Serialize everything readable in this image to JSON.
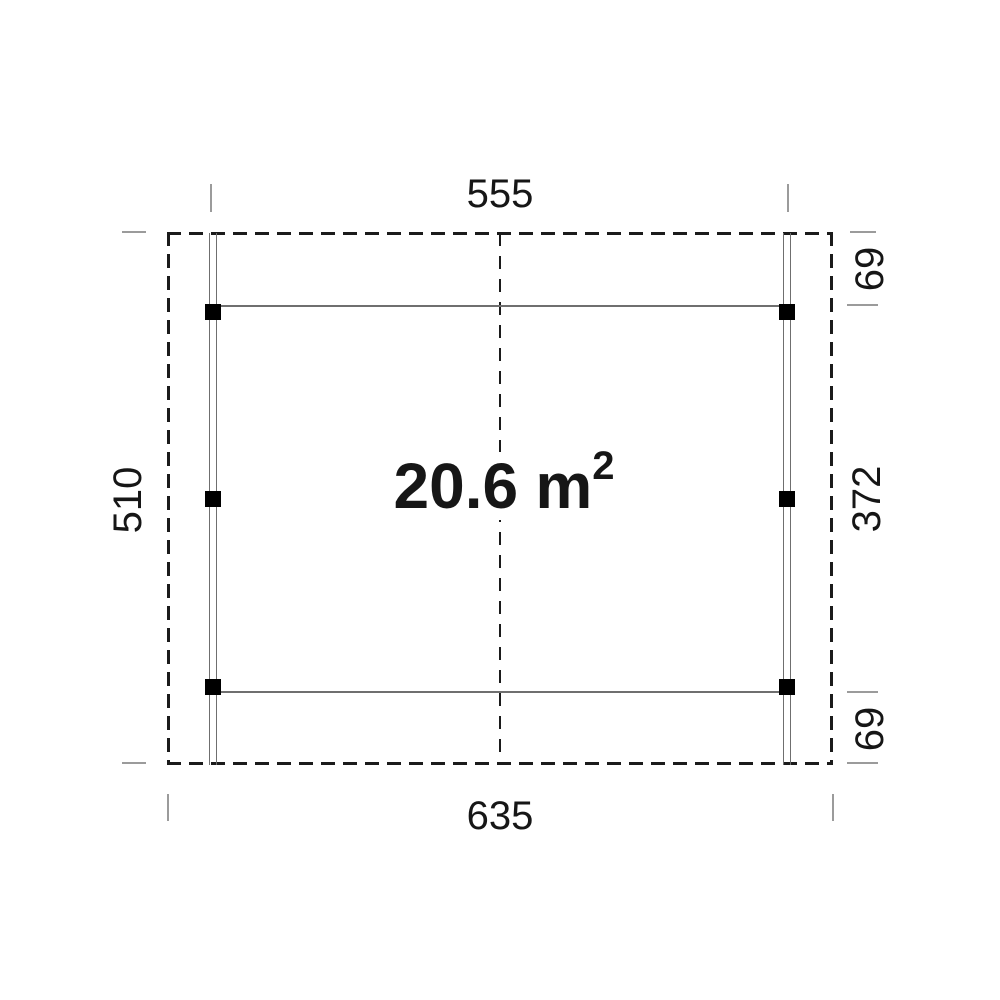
{
  "plan": {
    "area_value": "20.6",
    "area_unit": "m",
    "area_exponent": "2",
    "dim_top": "555",
    "dim_bottom": "635",
    "dim_left": "510",
    "dim_right_top": "69",
    "dim_right_middle": "372",
    "dim_right_bottom": "69"
  },
  "colors": {
    "outline": "#1b1b1b",
    "structure": "#6f6f6f",
    "tick": "#9b9b9b",
    "marker": "#000000",
    "text": "#161616",
    "bg": "#ffffff"
  }
}
